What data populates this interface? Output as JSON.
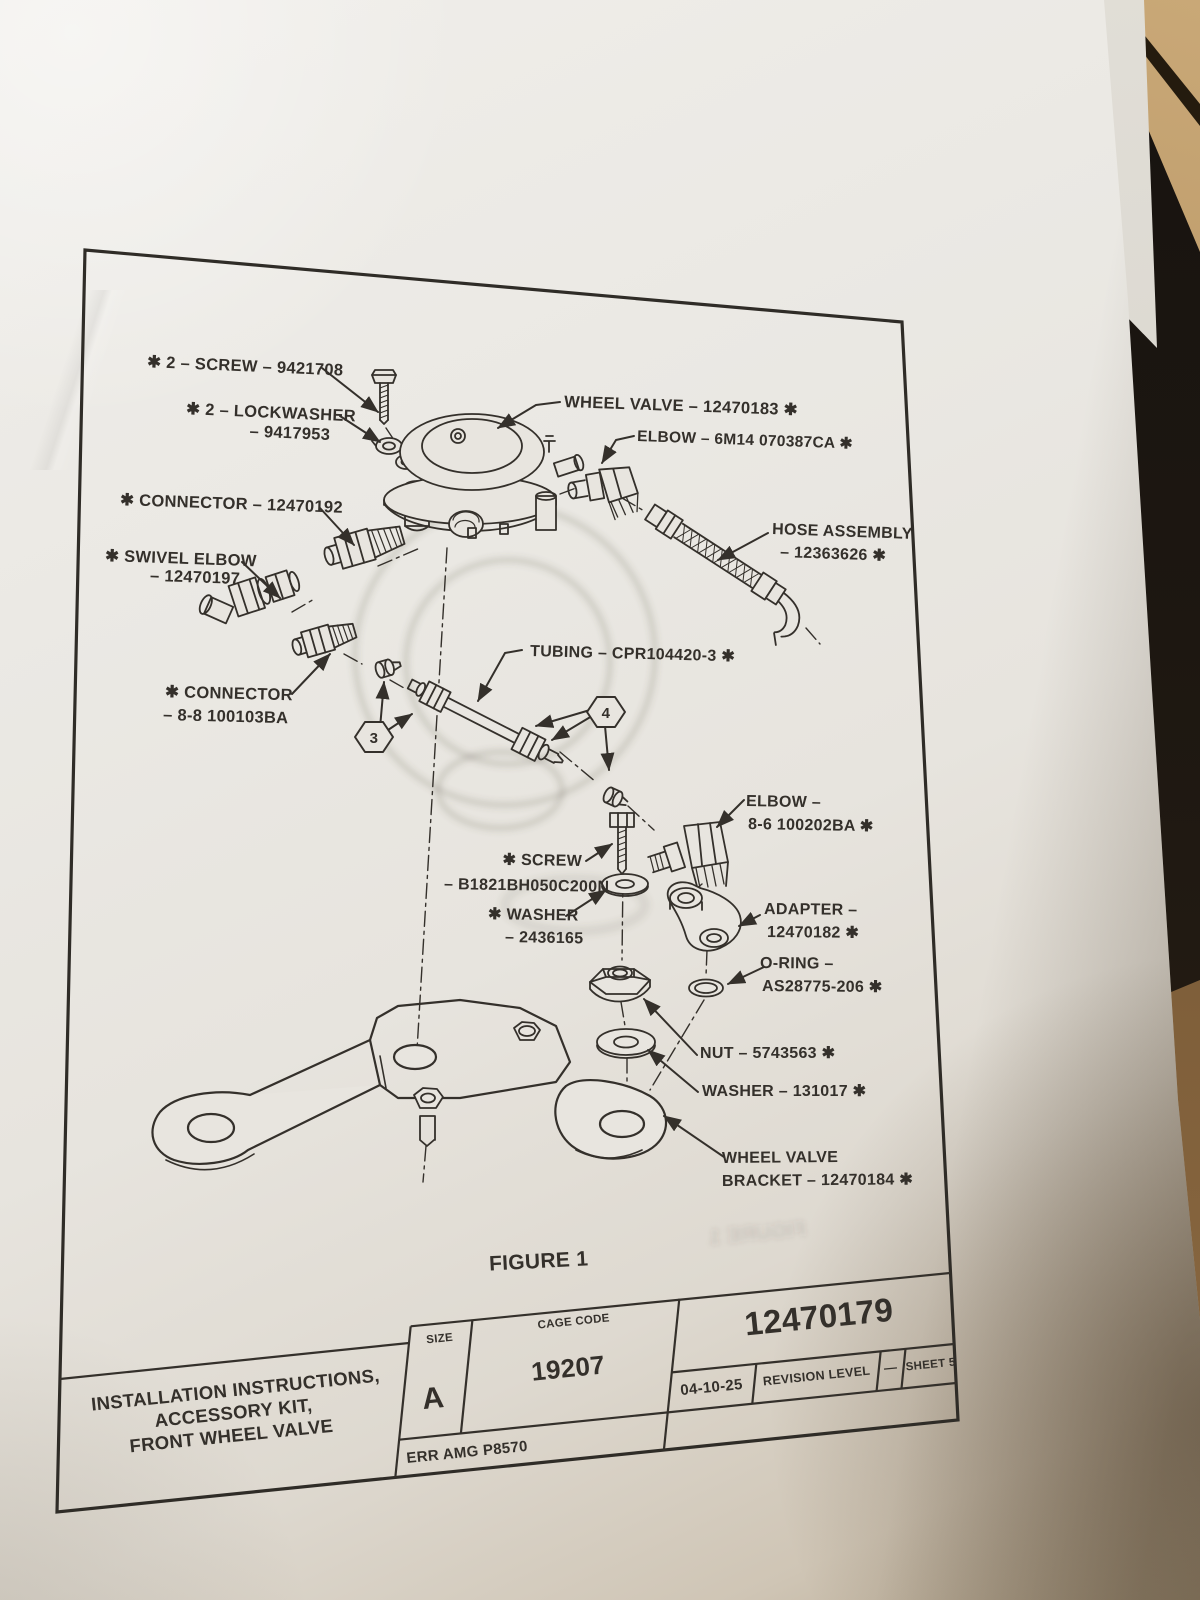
{
  "document": {
    "figure_caption": "FIGURE 1",
    "ghost_caption": "FIGURE 1",
    "callouts": {
      "hex3": "3",
      "hex4": "4"
    },
    "labels": {
      "screw2": "✱ 2 – SCREW – 9421708",
      "lockwasher_l1": "✱ 2 – LOCKWASHER",
      "lockwasher_l2": "– 9417953",
      "connector192": "✱ CONNECTOR – 12470192",
      "swivel_l1": "✱ SWIVEL ELBOW",
      "swivel_l2": "– 12470197",
      "wheel_valve": "WHEEL VALVE – 12470183 ✱",
      "elbow_6m14": "ELBOW – 6M14 070387CA ✱",
      "hose_l1": "HOSE ASSEMBLY",
      "hose_l2": "– 12363626 ✱",
      "connector88_l1": "✱ CONNECTOR",
      "connector88_l2": "– 8-8 100103BA",
      "tubing": "TUBING – CPR104420-3 ✱",
      "elbow86_l1": "ELBOW –",
      "elbow86_l2": "8-6 100202BA ✱",
      "screwb_l1": "✱ SCREW",
      "screwb_l2": "– B1821BH050C200N",
      "washer243_l1": "✱ WASHER",
      "washer243_l2": "– 2436165",
      "adapter_l1": "ADAPTER –",
      "adapter_l2": "12470182 ✱",
      "oring_l1": "O-RING –",
      "oring_l2": "AS28775-206 ✱",
      "nut": "NUT – 5743563 ✱",
      "washer131": "WASHER – 131017 ✱",
      "bracket_l1": "WHEEL VALVE",
      "bracket_l2": "BRACKET – 12470184 ✱"
    }
  },
  "title_block": {
    "title_l1": "INSTALLATION INSTRUCTIONS,",
    "title_l2": "ACCESSORY KIT,",
    "title_l3": "FRONT WHEEL VALVE",
    "size_label": "SIZE",
    "size_value": "A",
    "cage_label": "CAGE CODE",
    "cage_value": "19207",
    "part_number": "12470179",
    "date": "04-10-25",
    "revision_label": "REVISION LEVEL",
    "revision_value": "—",
    "sheet_label": "SHEET 5",
    "err_note": "ERR  AMG P8570"
  }
}
